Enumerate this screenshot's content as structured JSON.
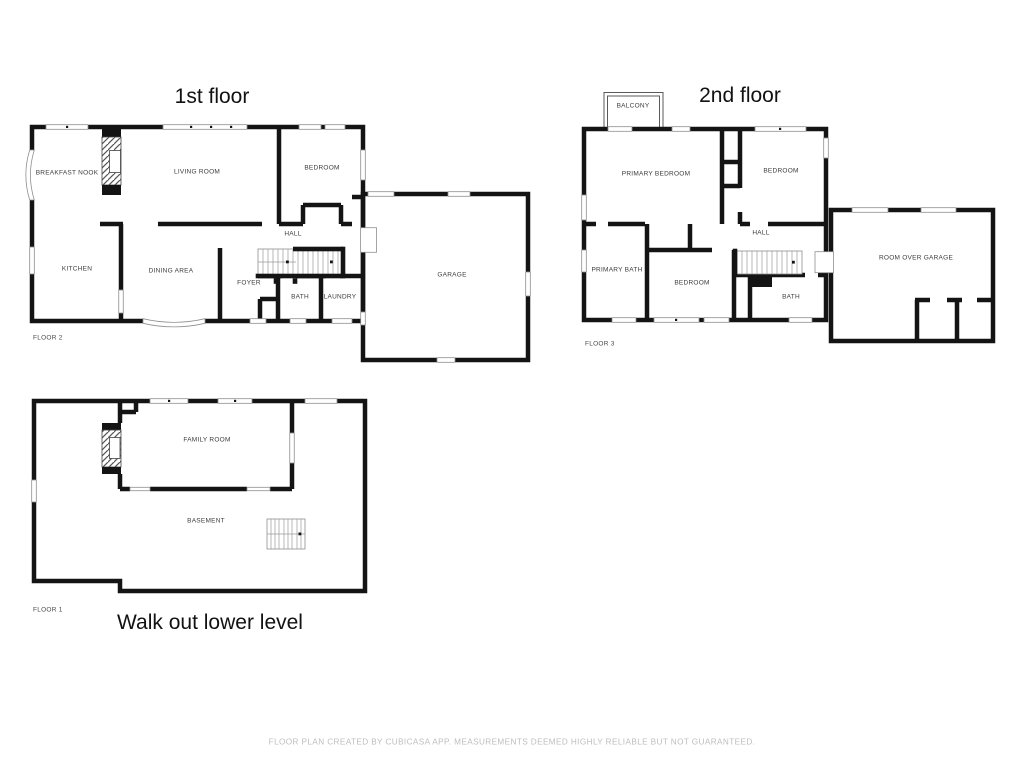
{
  "floors": {
    "first": {
      "title": "1st floor",
      "tag": "FLOOR 2",
      "rooms": {
        "breakfast_nook": "BREAKFAST NOOK",
        "living_room": "LIVING ROOM",
        "bedroom": "BEDROOM",
        "kitchen": "KITCHEN",
        "dining_area": "DINING AREA",
        "hall": "HALL",
        "foyer": "FOYER",
        "bath": "BATH",
        "laundry": "LAUNDRY",
        "garage": "GARAGE"
      }
    },
    "second": {
      "title": "2nd floor",
      "tag": "FLOOR 3",
      "rooms": {
        "balcony": "BALCONY",
        "primary_bedroom": "PRIMARY BEDROOM",
        "bedroom_right": "BEDROOM",
        "hall": "HALL",
        "primary_bath": "PRIMARY BATH",
        "bedroom_bottom": "BEDROOM",
        "bath": "BATH",
        "room_over_garage": "ROOM OVER GARAGE"
      }
    },
    "lower": {
      "title": "Walk out lower level",
      "tag": "FLOOR 1",
      "rooms": {
        "family_room": "FAMILY ROOM",
        "basement": "BASEMENT"
      }
    }
  },
  "footer": {
    "disclaimer": "FLOOR PLAN CREATED BY CUBICASA APP. MEASUREMENTS DEEMED HIGHLY RELIABLE BUT NOT GUARANTEED."
  },
  "colors": {
    "wall": "#141414",
    "room_label": "#3c3c3c",
    "window_outline": "#8f8f8f",
    "footer_text": "#bdbdbd"
  }
}
